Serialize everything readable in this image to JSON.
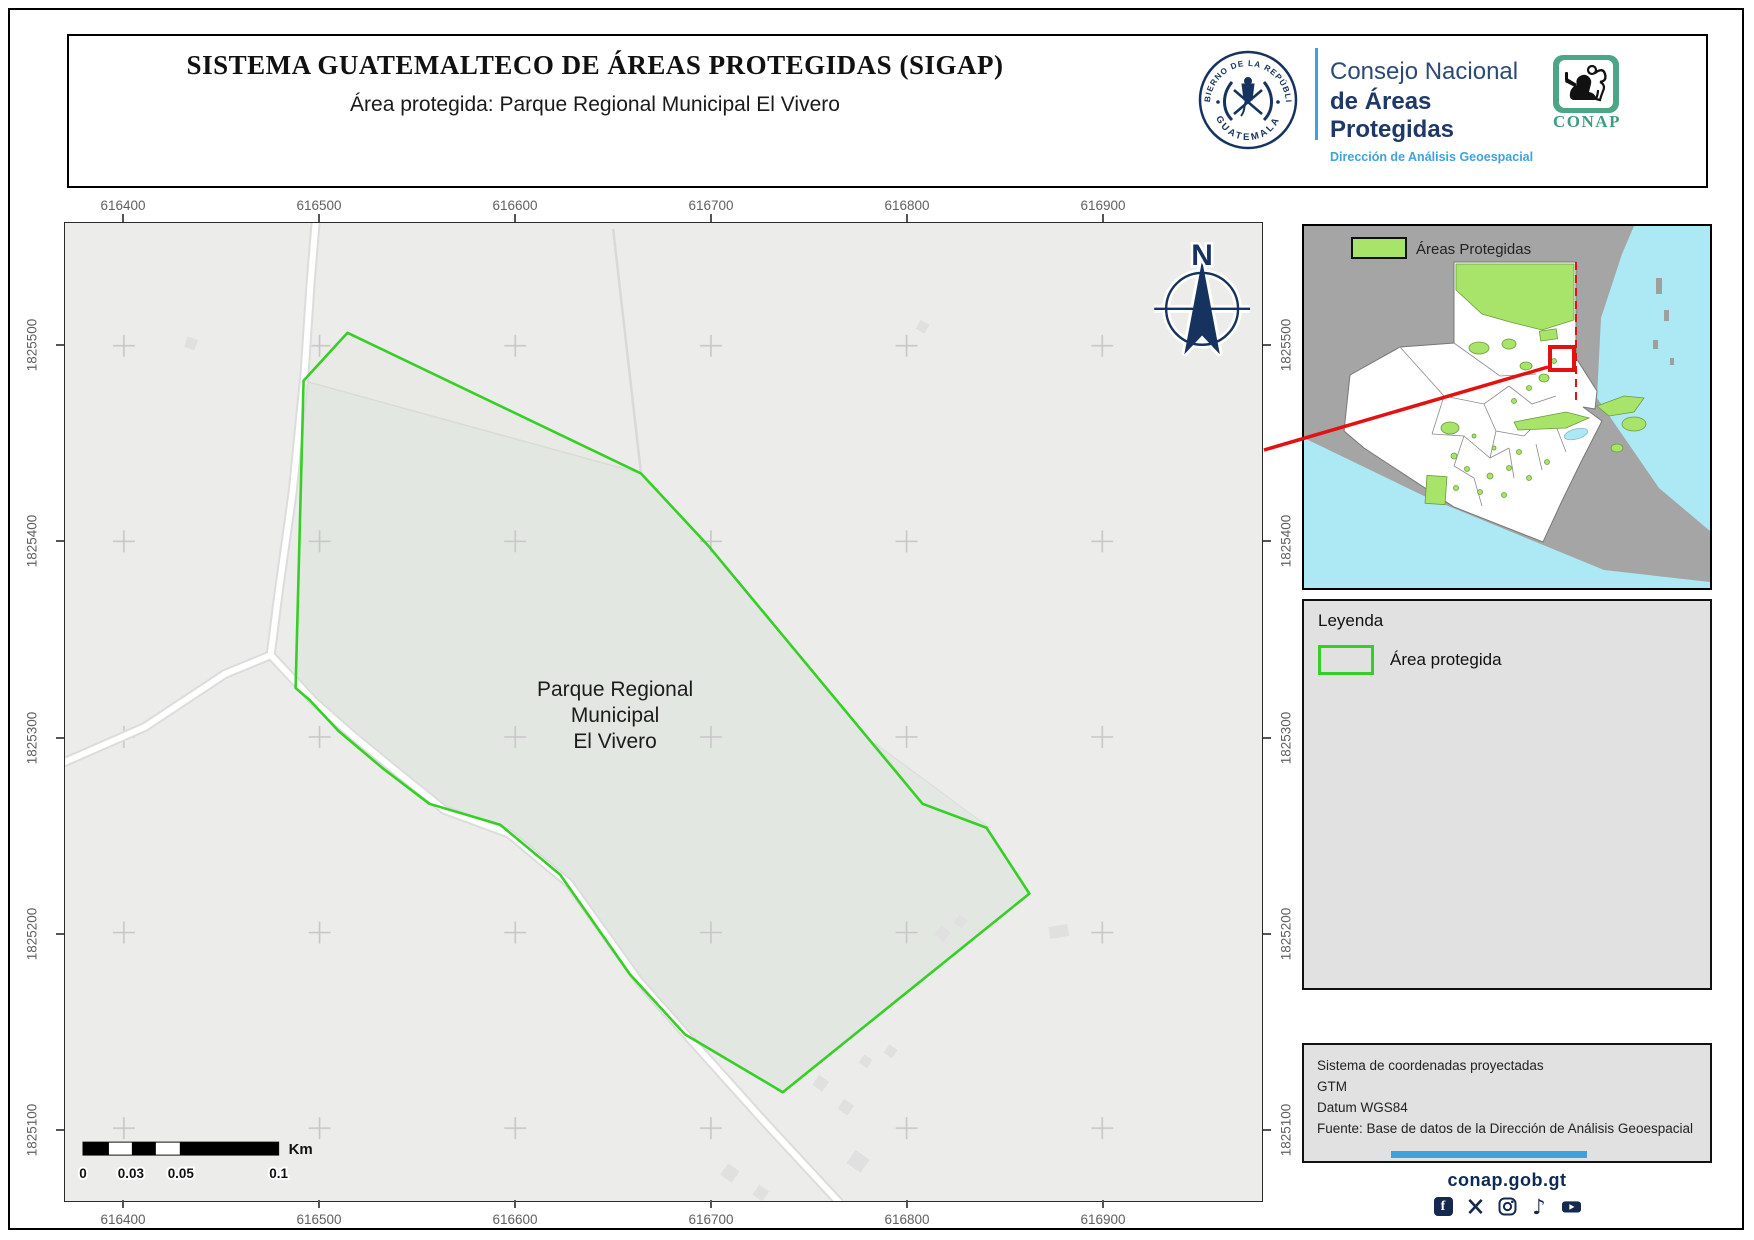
{
  "header": {
    "title": "SISTEMA GUATEMALTECO DE ÁREAS PROTEGIDAS  (SIGAP)",
    "subtitle": "Área protegida: Parque Regional Municipal El Vivero"
  },
  "branding": {
    "seal_text_top": "GOBIERNO DE LA REPÚBLICA",
    "seal_text_bottom": "GUATEMALA",
    "council_line1": "Consejo Nacional",
    "council_line2": "de Áreas Protegidas",
    "council_line3": "Dirección de Análisis Geoespacial",
    "conap_wordmark": "CONAP"
  },
  "map": {
    "north_label": "N",
    "x_ticks": [
      "616400",
      "616500",
      "616600",
      "616700",
      "616800",
      "616900"
    ],
    "y_ticks": [
      "1825500",
      "1825400",
      "1825300",
      "1825200",
      "1825100"
    ],
    "area_label": {
      "line1": "Parque Regional",
      "line2": "Municipal",
      "line3": "El Vivero"
    }
  },
  "scalebar": {
    "tick0": "0",
    "tick1": "0.03",
    "tick2": "0.05",
    "tick3": "0.1",
    "unit": "Km"
  },
  "inset": {
    "legend_label": "Áreas Protegidas"
  },
  "legend": {
    "title": "Leyenda",
    "item_label": "Área protegida"
  },
  "metadata": {
    "line1": "Sistema de coordenadas proyectadas",
    "line2": "GTM",
    "line3": "Datum WGS84",
    "line4": "Fuente: Base de datos de la Dirección de Análisis Geoespacial"
  },
  "footer": {
    "website": "conap.gob.gt",
    "social_icons": [
      "facebook-icon",
      "x-icon",
      "instagram-icon",
      "tiktok-icon",
      "youtube-icon"
    ]
  },
  "colors": {
    "protected_outline": "#35cf25",
    "protected_fill": "#e3e7e2",
    "inset_green": "#a7e469",
    "water": "#ade9f5",
    "navy": "#16335f",
    "light_blue": "#3fa0dc",
    "red": "#e31212",
    "conap_green": "#4ca584"
  }
}
